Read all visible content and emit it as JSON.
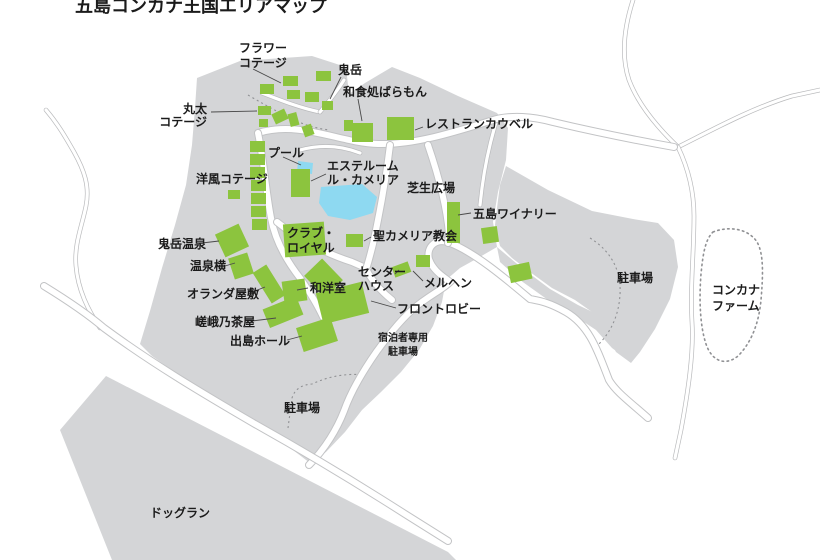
{
  "title": "五島コンカナ王国エリアマップ",
  "colors": {
    "land": "#d4d5d7",
    "building_green": "#8cc43e",
    "water_blue": "#8ed9f1",
    "road_fill": "#ffffff",
    "road_casing": "#c2c3c5",
    "thin_line": "#b9babc",
    "text": "#1b1b1b",
    "pointer": "#4a4a4a",
    "dotted": "#909194"
  },
  "map_data": {
    "land_areas": [
      {
        "name": "main-resort-area",
        "path": "M197,78 L240,61 L312,56 L346,67 L349,94 L365,83 L392,67 L420,78 L458,96 L497,113 L508,128 L506,160 L498,192 L493,222 L497,247 L478,258 L460,268 L446,280 L442,302 L433,326 L419,350 L401,372 L381,392 L362,410 L345,432 L326,452 L310,463 L255,421 L200,390 L152,356 L140,344 L150,311 L162,268 L175,225 L186,185 L192,145 L195,108 Z"
      },
      {
        "name": "east-arm-parking-area",
        "path": "M506,166 L548,190 L592,211 L633,219 L658,223 L674,240 L678,267 L670,299 L655,329 L640,352 L631,363 L616,352 L604,330 L592,312 L575,300 L552,288 L530,272 L512,258 L500,246 L495,225 L498,200 L500,185 Z"
      },
      {
        "name": "guest-parking-strip",
        "path": "M497,247 L522,268 L550,289 L578,305 L603,317 L616,325 L625,345 L631,362 L612,348 L596,330 L575,316 L548,300 L520,280 L500,262 Z"
      },
      {
        "name": "dog-run-area",
        "path": "M106,376 L448,552 L456,560 L112,560 L60,430 Z"
      }
    ],
    "roads_main": [
      "M258,133 C300,120 340,143 378,144 C414,145 455,132 490,121 C510,114 535,117 553,122 C595,132 635,140 674,147",
      "M648,418 C630,402 616,392 609,380 C598,352 590,326 566,312 C548,302 540,301 530,299 C505,278 474,252 450,243 C436,237 426,247 429,259 C433,271 444,277 450,282 C442,290 428,296 413,309 C398,323 389,335 377,351 C363,371 351,391 344,411 C337,429 325,449 309,465",
      "M44,286 C70,302 90,316 104,328 C150,362 200,392 255,424 C305,452 355,482 405,514 L448,541",
      "M258,133 C264,162 266,192 271,218 C275,240 286,260 300,278 C309,291 317,304 323,317",
      "M277,222 C299,240 327,254 352,262 L368,269",
      "M390,145 C386,178 380,212 373,244 C370,256 368,264 366,269 C372,281 382,292 392,300",
      "M428,145 C440,180 447,210 449,234 L448,243"
    ],
    "roads_thin": [
      "M46,110 C58,124 66,138 74,152 C84,170 90,186 86,206 C82,226 74,244 76,266 C78,290 88,310 100,328",
      "M633,0 C624,28 621,56 629,80 C638,104 658,128 678,147",
      "M678,147 C712,130 752,108 792,96 L820,90",
      "M678,147 C688,168 694,192 694,216 C694,252 690,288 692,322 C694,352 688,392 681,430 L675,458",
      "M497,119 C490,142 485,165 482,188 L480,205",
      "M300,150 C322,144 342,146 360,153",
      "M262,93 C280,100 300,108 320,112",
      "M320,112 C330,100 338,90 344,80"
    ],
    "dashed_lines": [
      "M590,238 Q622,258 620,295 Q618,325 598,345",
      "M288,428 L292,398 Q296,385 312,384 Q338,372 365,375",
      "M248,95 Q270,108 290,118 Q310,128 330,130"
    ],
    "farm_outline": "M713,232 C728,226 748,228 757,242 C764,254 763,276 761,300 C759,322 752,342 738,356 C726,366 712,362 706,344 C700,326 699,300 701,274 C703,254 705,240 713,232 Z",
    "pools": [
      {
        "name": "pool-small",
        "path": "M298,161 L313,163 L312,174 L297,172 Z"
      },
      {
        "name": "pool-main",
        "path": "M321,187 L362,184 L377,197 L373,213 L350,220 L328,216 L319,203 Z"
      }
    ],
    "buildings": [
      {
        "name": "flower-cottage-1",
        "x": 260,
        "y": 84,
        "w": 14,
        "h": 10,
        "r": 0
      },
      {
        "name": "flower-cottage-2",
        "x": 283,
        "y": 76,
        "w": 15,
        "h": 10,
        "r": 0
      },
      {
        "name": "flower-cottage-3",
        "x": 316,
        "y": 71,
        "w": 15,
        "h": 10,
        "r": 0
      },
      {
        "name": "flower-cottage-4",
        "x": 305,
        "y": 92,
        "w": 14,
        "h": 10,
        "r": 0
      },
      {
        "name": "flower-cottage-5",
        "x": 287,
        "y": 90,
        "w": 13,
        "h": 9,
        "r": 0
      },
      {
        "name": "flower-cottage-6",
        "x": 258,
        "y": 106,
        "w": 13,
        "h": 9,
        "r": 0
      },
      {
        "name": "flower-cottage-7",
        "x": 273,
        "y": 111,
        "w": 14,
        "h": 11,
        "r": -25
      },
      {
        "name": "flower-cottage-8",
        "x": 289,
        "y": 113,
        "w": 9,
        "h": 13,
        "r": -15
      },
      {
        "name": "flower-cottage-9",
        "x": 322,
        "y": 101,
        "w": 11,
        "h": 9,
        "r": 0
      },
      {
        "name": "flower-cottage-10",
        "x": 303,
        "y": 125,
        "w": 10,
        "h": 11,
        "r": -20
      },
      {
        "name": "flower-cottage-11",
        "x": 259,
        "y": 119,
        "w": 9,
        "h": 8,
        "r": 0
      },
      {
        "name": "flower-cottage-12",
        "x": 344,
        "y": 120,
        "w": 9,
        "h": 11,
        "r": 0
      },
      {
        "name": "western-cottage-1",
        "x": 250,
        "y": 141,
        "w": 15,
        "h": 11,
        "r": 0
      },
      {
        "name": "western-cottage-2",
        "x": 250,
        "y": 154,
        "w": 15,
        "h": 11,
        "r": 0
      },
      {
        "name": "western-cottage-3",
        "x": 250,
        "y": 167,
        "w": 15,
        "h": 11,
        "r": 0
      },
      {
        "name": "western-cottage-4",
        "x": 251,
        "y": 180,
        "w": 15,
        "h": 11,
        "r": 0
      },
      {
        "name": "western-cottage-5",
        "x": 251,
        "y": 193,
        "w": 15,
        "h": 11,
        "r": 0
      },
      {
        "name": "western-cottage-6",
        "x": 251,
        "y": 206,
        "w": 15,
        "h": 11,
        "r": 0
      },
      {
        "name": "western-cottage-7",
        "x": 252,
        "y": 219,
        "w": 15,
        "h": 11,
        "r": 0
      },
      {
        "name": "western-cottage-8",
        "x": 228,
        "y": 190,
        "w": 12,
        "h": 9,
        "r": 0
      },
      {
        "name": "washoku-baramon-building",
        "x": 352,
        "y": 123,
        "w": 21,
        "h": 19,
        "r": 0
      },
      {
        "name": "restaurant-cowbell-building",
        "x": 387,
        "y": 117,
        "w": 27,
        "h": 23,
        "r": 0
      },
      {
        "name": "esthe-room-building",
        "x": 291,
        "y": 169,
        "w": 19,
        "h": 28,
        "r": 0
      },
      {
        "name": "onidake-onsen-building",
        "x": 219,
        "y": 228,
        "w": 26,
        "h": 25,
        "r": -25
      },
      {
        "name": "onsen-yoko-building",
        "x": 231,
        "y": 255,
        "w": 20,
        "h": 22,
        "r": -18
      },
      {
        "name": "holland-yashiki-building",
        "x": 261,
        "y": 266,
        "w": 16,
        "h": 36,
        "r": -32
      },
      {
        "name": "wayoshitsu-building-1",
        "x": 283,
        "y": 280,
        "w": 23,
        "h": 22,
        "r": -8
      },
      {
        "name": "wayoshitsu-building-2",
        "x": 311,
        "y": 263,
        "w": 25,
        "h": 30,
        "r": -44
      },
      {
        "name": "saganochaya-building",
        "x": 265,
        "y": 302,
        "w": 36,
        "h": 20,
        "r": -22
      },
      {
        "name": "dejima-hall-building",
        "x": 299,
        "y": 322,
        "w": 36,
        "h": 25,
        "r": -18
      },
      {
        "name": "front-lobby-building",
        "x": 319,
        "y": 287,
        "w": 47,
        "h": 32,
        "r": -14
      },
      {
        "name": "club-royal-building",
        "x": 284,
        "y": 223,
        "w": 41,
        "h": 33,
        "r": -4
      },
      {
        "name": "st-camellia-church-building",
        "x": 346,
        "y": 234,
        "w": 17,
        "h": 13,
        "r": 0
      },
      {
        "name": "center-house-building-1",
        "x": 393,
        "y": 264,
        "w": 17,
        "h": 11,
        "r": -20
      },
      {
        "name": "center-house-building-2",
        "x": 416,
        "y": 255,
        "w": 14,
        "h": 12,
        "r": 0
      },
      {
        "name": "goto-winery-strip-building",
        "x": 447,
        "y": 202,
        "w": 13,
        "h": 41,
        "r": 0
      },
      {
        "name": "goto-winery-building",
        "x": 482,
        "y": 227,
        "w": 16,
        "h": 16,
        "r": -8
      },
      {
        "name": "east-arm-building",
        "x": 509,
        "y": 264,
        "w": 22,
        "h": 17,
        "r": -12
      }
    ],
    "pointer_lines": [
      [
        253,
        69,
        281,
        83
      ],
      [
        211,
        112,
        257,
        111
      ],
      [
        341,
        77,
        330,
        99
      ],
      [
        358,
        99,
        362,
        121
      ],
      [
        423,
        127,
        415,
        130
      ],
      [
        283,
        157,
        301,
        165
      ],
      [
        326,
        174,
        311,
        181
      ],
      [
        202,
        243,
        219,
        241
      ],
      [
        225,
        266,
        235,
        263
      ],
      [
        250,
        293,
        265,
        287
      ],
      [
        252,
        321,
        276,
        318
      ],
      [
        287,
        340,
        302,
        336
      ],
      [
        371,
        237,
        364,
        241
      ],
      [
        395,
        274,
        399,
        270
      ],
      [
        423,
        281,
        413,
        271
      ],
      [
        471,
        213,
        458,
        215
      ],
      [
        396,
        308,
        371,
        301
      ],
      [
        308,
        288,
        297,
        290
      ]
    ],
    "labels": [
      {
        "name": "map-title",
        "lines": [
          "五島コンカナ王国エリアマップ"
        ],
        "x": 75,
        "y": 12,
        "size": 18,
        "lh": 20,
        "anchor": "start"
      },
      {
        "name": "label-flower-cottage",
        "lines": [
          "フラワー",
          "コテージ"
        ],
        "x": 239,
        "y": 52,
        "size": 12,
        "lh": 15,
        "anchor": "start"
      },
      {
        "name": "label-onidake",
        "lines": [
          "鬼岳"
        ],
        "x": 338,
        "y": 74,
        "size": 12,
        "lh": 15,
        "anchor": "start"
      },
      {
        "name": "label-washoku-baramon",
        "lines": [
          "和食処ばらもん"
        ],
        "x": 343,
        "y": 96,
        "size": 12,
        "lh": 15,
        "anchor": "start"
      },
      {
        "name": "label-maruta-cottage",
        "lines": [
          "丸太",
          "コテージ"
        ],
        "x": 207,
        "y": 113,
        "size": 12,
        "lh": 13,
        "anchor": "end"
      },
      {
        "name": "label-restaurant-cowbell",
        "lines": [
          "レストランカウベル"
        ],
        "x": 425,
        "y": 128,
        "size": 12,
        "lh": 15,
        "anchor": "start"
      },
      {
        "name": "label-pool",
        "lines": [
          "プール"
        ],
        "x": 268,
        "y": 157,
        "size": 12,
        "lh": 15,
        "anchor": "start"
      },
      {
        "name": "label-esthe-room",
        "lines": [
          "エステルーム",
          "ル・カメリア"
        ],
        "x": 327,
        "y": 170,
        "size": 12,
        "lh": 14,
        "anchor": "start"
      },
      {
        "name": "label-western-cottage",
        "lines": [
          "洋風コテージ"
        ],
        "x": 196,
        "y": 183,
        "size": 12,
        "lh": 15,
        "anchor": "start"
      },
      {
        "name": "label-lawn-plaza",
        "lines": [
          "芝生広場"
        ],
        "x": 407,
        "y": 192,
        "size": 12,
        "lh": 15,
        "anchor": "start"
      },
      {
        "name": "label-goto-winery",
        "lines": [
          "五島ワイナリー"
        ],
        "x": 473,
        "y": 218,
        "size": 12,
        "lh": 15,
        "anchor": "start"
      },
      {
        "name": "label-st-camellia-church",
        "lines": [
          "聖カメリア教会"
        ],
        "x": 373,
        "y": 240,
        "size": 12,
        "lh": 15,
        "anchor": "start"
      },
      {
        "name": "label-onidake-onsen",
        "lines": [
          "鬼岳温泉"
        ],
        "x": 158,
        "y": 248,
        "size": 12,
        "lh": 15,
        "anchor": "start"
      },
      {
        "name": "label-club-royal",
        "lines": [
          "クラブ・",
          "ロイヤル"
        ],
        "x": 287,
        "y": 237,
        "size": 12,
        "lh": 15,
        "anchor": "start"
      },
      {
        "name": "label-onsen-yoko",
        "lines": [
          "温泉横"
        ],
        "x": 190,
        "y": 270,
        "size": 12,
        "lh": 15,
        "anchor": "start"
      },
      {
        "name": "label-center-house",
        "lines": [
          "センター",
          "ハウス"
        ],
        "x": 358,
        "y": 276,
        "size": 12,
        "lh": 14,
        "anchor": "start"
      },
      {
        "name": "label-marchen",
        "lines": [
          "メルヘン"
        ],
        "x": 424,
        "y": 287,
        "size": 12,
        "lh": 15,
        "anchor": "start"
      },
      {
        "name": "label-holland-yashiki",
        "lines": [
          "オランダ屋敷"
        ],
        "x": 187,
        "y": 298,
        "size": 12,
        "lh": 15,
        "anchor": "start"
      },
      {
        "name": "label-wayoshitsu",
        "lines": [
          "和洋室"
        ],
        "x": 310,
        "y": 292,
        "size": 12,
        "lh": 15,
        "anchor": "start"
      },
      {
        "name": "label-front-lobby",
        "lines": [
          "フロントロビー"
        ],
        "x": 397,
        "y": 313,
        "size": 12,
        "lh": 15,
        "anchor": "start"
      },
      {
        "name": "label-saganochaya",
        "lines": [
          "嵯峨乃茶屋"
        ],
        "x": 195,
        "y": 326,
        "size": 12,
        "lh": 15,
        "anchor": "start"
      },
      {
        "name": "label-dejima-hall",
        "lines": [
          "出島ホール"
        ],
        "x": 230,
        "y": 345,
        "size": 12,
        "lh": 15,
        "anchor": "start"
      },
      {
        "name": "label-guest-parking",
        "lines": [
          "宿泊者専用",
          "駐車場"
        ],
        "x": 378,
        "y": 341,
        "size": 10,
        "lh": 14,
        "anchor": "start",
        "dx2": 10
      },
      {
        "name": "label-parking-east",
        "lines": [
          "駐車場"
        ],
        "x": 617,
        "y": 282,
        "size": 12,
        "lh": 15,
        "anchor": "start"
      },
      {
        "name": "label-konkana-farm",
        "lines": [
          "コンカナ",
          "ファーム"
        ],
        "x": 712,
        "y": 294,
        "size": 12,
        "lh": 16,
        "anchor": "start"
      },
      {
        "name": "label-parking-south",
        "lines": [
          "駐車場"
        ],
        "x": 284,
        "y": 412,
        "size": 12,
        "lh": 15,
        "anchor": "start"
      },
      {
        "name": "label-dog-run",
        "lines": [
          "ドッグラン"
        ],
        "x": 150,
        "y": 517,
        "size": 12,
        "lh": 15,
        "anchor": "start"
      }
    ]
  }
}
